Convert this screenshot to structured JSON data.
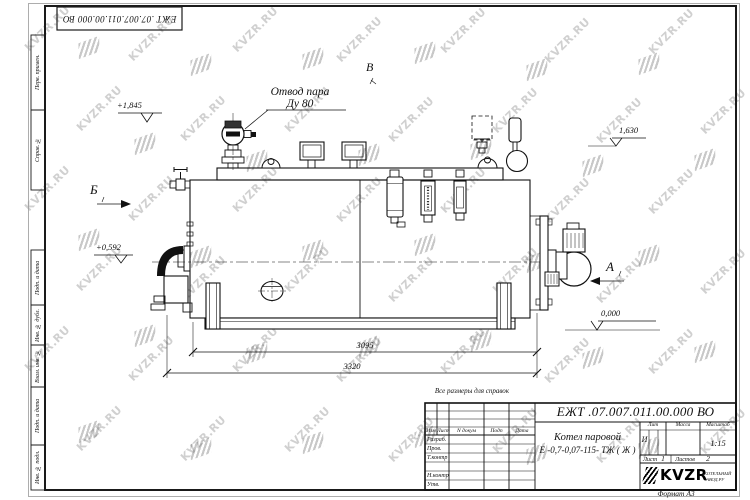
{
  "watermark": {
    "text": "KVZR.RU"
  },
  "frame": {
    "top_stamp": "ЕЖТ .07.007.011.00.000  ВО",
    "format_note": "Формат А3",
    "margin_labels": [
      "Перв. примен.",
      "Справ. №",
      "Подп. и дата",
      "Инв. № дубл.",
      "Взам. инв. №",
      "Подп. и дата",
      "Инв. № подл."
    ]
  },
  "drawing": {
    "note": "Все размеры для справок",
    "callout": {
      "line1": "Отвод пара",
      "line2": "Ду 80"
    },
    "views": {
      "a": "А",
      "b": "Б",
      "v": "В"
    },
    "elevations": {
      "valve_top": "+1,845",
      "shell_top": "1,630",
      "axis": "+0,592",
      "ground": "0,000"
    },
    "dimensions": {
      "shell_length": "3095",
      "overall_length": "3320"
    }
  },
  "title_block": {
    "doc_number": "ЕЖТ .07.007.011.00.000  ВО",
    "product_name": "Котел паровой",
    "product_model": "Е -0,7-0,07-115- ТЖ ( Ж )",
    "columns": {
      "izm": "Изм",
      "list": "Лист",
      "doc": "N докум",
      "sign": "Подп",
      "date": "Дата"
    },
    "roles": [
      "Разраб.",
      "Пров.",
      "Т.контр",
      "",
      "Н.контр",
      "Утв."
    ],
    "lit": {
      "label": "Лит",
      "value": "И"
    },
    "mass": {
      "label": "Масса",
      "value": ""
    },
    "scale": {
      "label": "Масштаб",
      "value": "1:15"
    },
    "sheet": {
      "label": "Лист",
      "value": "1"
    },
    "sheets": {
      "label": "Листов",
      "value": "2"
    },
    "logo": {
      "name": "KVZR",
      "sub1": "КОТЕЛЬНЫЙ",
      "sub2": "ЗАВОД.РУ"
    }
  }
}
